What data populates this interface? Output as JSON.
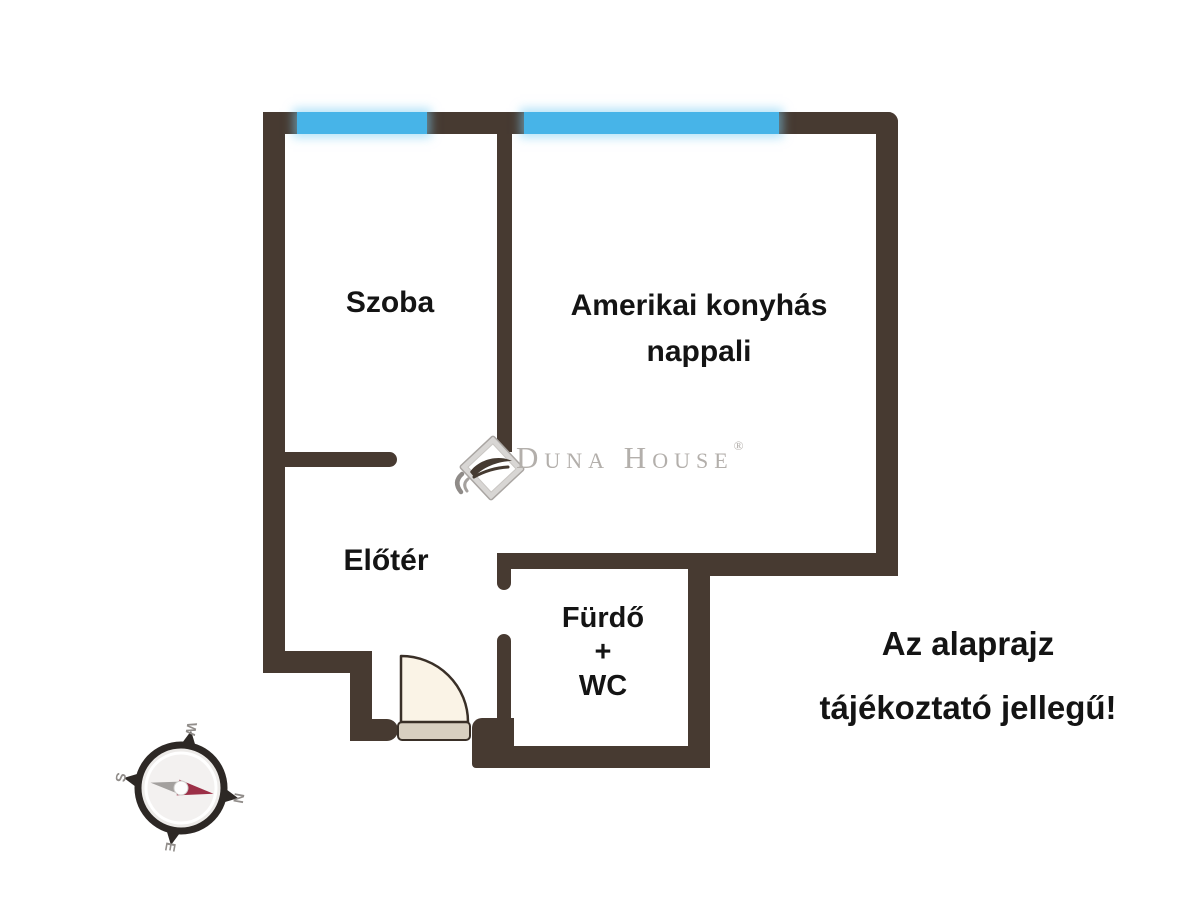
{
  "floorplan": {
    "rooms": [
      {
        "name": "szoba",
        "lines": [
          "Szoba"
        ]
      },
      {
        "name": "amerikai-konyhas-nappali",
        "lines": [
          "Amerikai konyhás",
          "nappali"
        ]
      },
      {
        "name": "eloter",
        "lines": [
          "Előtér"
        ]
      },
      {
        "name": "furdo-wc",
        "lines": [
          "Fürdő",
          "+",
          "WC"
        ]
      }
    ],
    "disclaimer": {
      "lines": [
        "Az alaprajz",
        "tájékoztató jellegű!"
      ]
    },
    "brand": {
      "name": "Duna House",
      "registered": "®"
    },
    "compass": {
      "n": "N",
      "e": "E",
      "s": "S",
      "w": "W"
    },
    "colors": {
      "wall": "#473a31",
      "window": "#47b4e8",
      "window_glow": "#7dcdf2",
      "label_text": "#141414",
      "brand_gray": "#b3afab",
      "door_leaf": "#faf3e6",
      "door_threshold": "#d8cfc0",
      "compass_dark": "#2d2825",
      "compass_needle_red": "#9c2f47",
      "compass_needle_gray": "#a3a09e"
    }
  }
}
